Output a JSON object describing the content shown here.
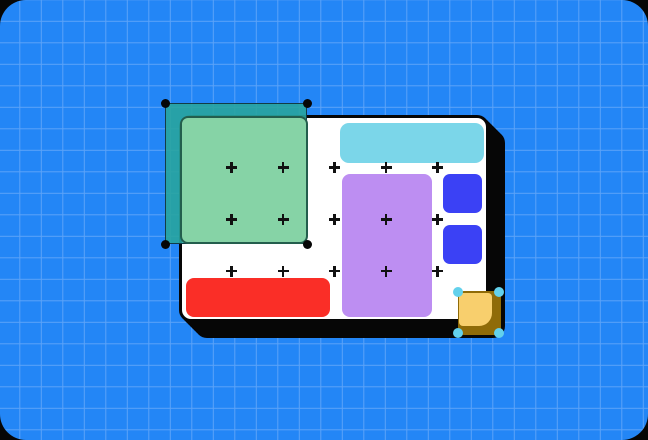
{
  "illustration": {
    "kind": "design-canvas-graphic",
    "description": "Blueprint-style blue grid canvas with a white artboard card; a green rectangle is selected with a teal marquee and black corner handles; a gold square at the card corner is being resized with cyan handles; colored blocks (cyan bar, purple panel, two blue squares, red bar) lie on the artboard among plus-shaped grid markers.",
    "text_content": []
  },
  "colors": {
    "frame-ink": "#060606",
    "bg-blue": "#2386f6",
    "grid-line": "#5ba3f8",
    "card-white": "#ffffff",
    "cyan": "#7bd6e9",
    "purple": "#bd8ef2",
    "blue-square": "#3b41f5",
    "red": "#fa2e27",
    "green": "#86d3a6",
    "green-border": "#235e4d",
    "sel-fill": "rgba(40,164,159,0.9)",
    "sel-border": "#123c46",
    "gold-dark": "#8f6b08",
    "gold-light": "#f8cf6d",
    "handle-cyan": "#63d1ec",
    "cross-ink": "#111111"
  },
  "markers": {
    "columns_x": [
      231.5,
      283,
      334.5,
      386,
      437.5
    ],
    "rows_y": [
      167.5,
      219.5,
      271
    ]
  },
  "selection": {
    "handle_count": 4,
    "handle_shape": "circle"
  },
  "resize": {
    "handle_count": 4,
    "handle_shape": "circle"
  }
}
